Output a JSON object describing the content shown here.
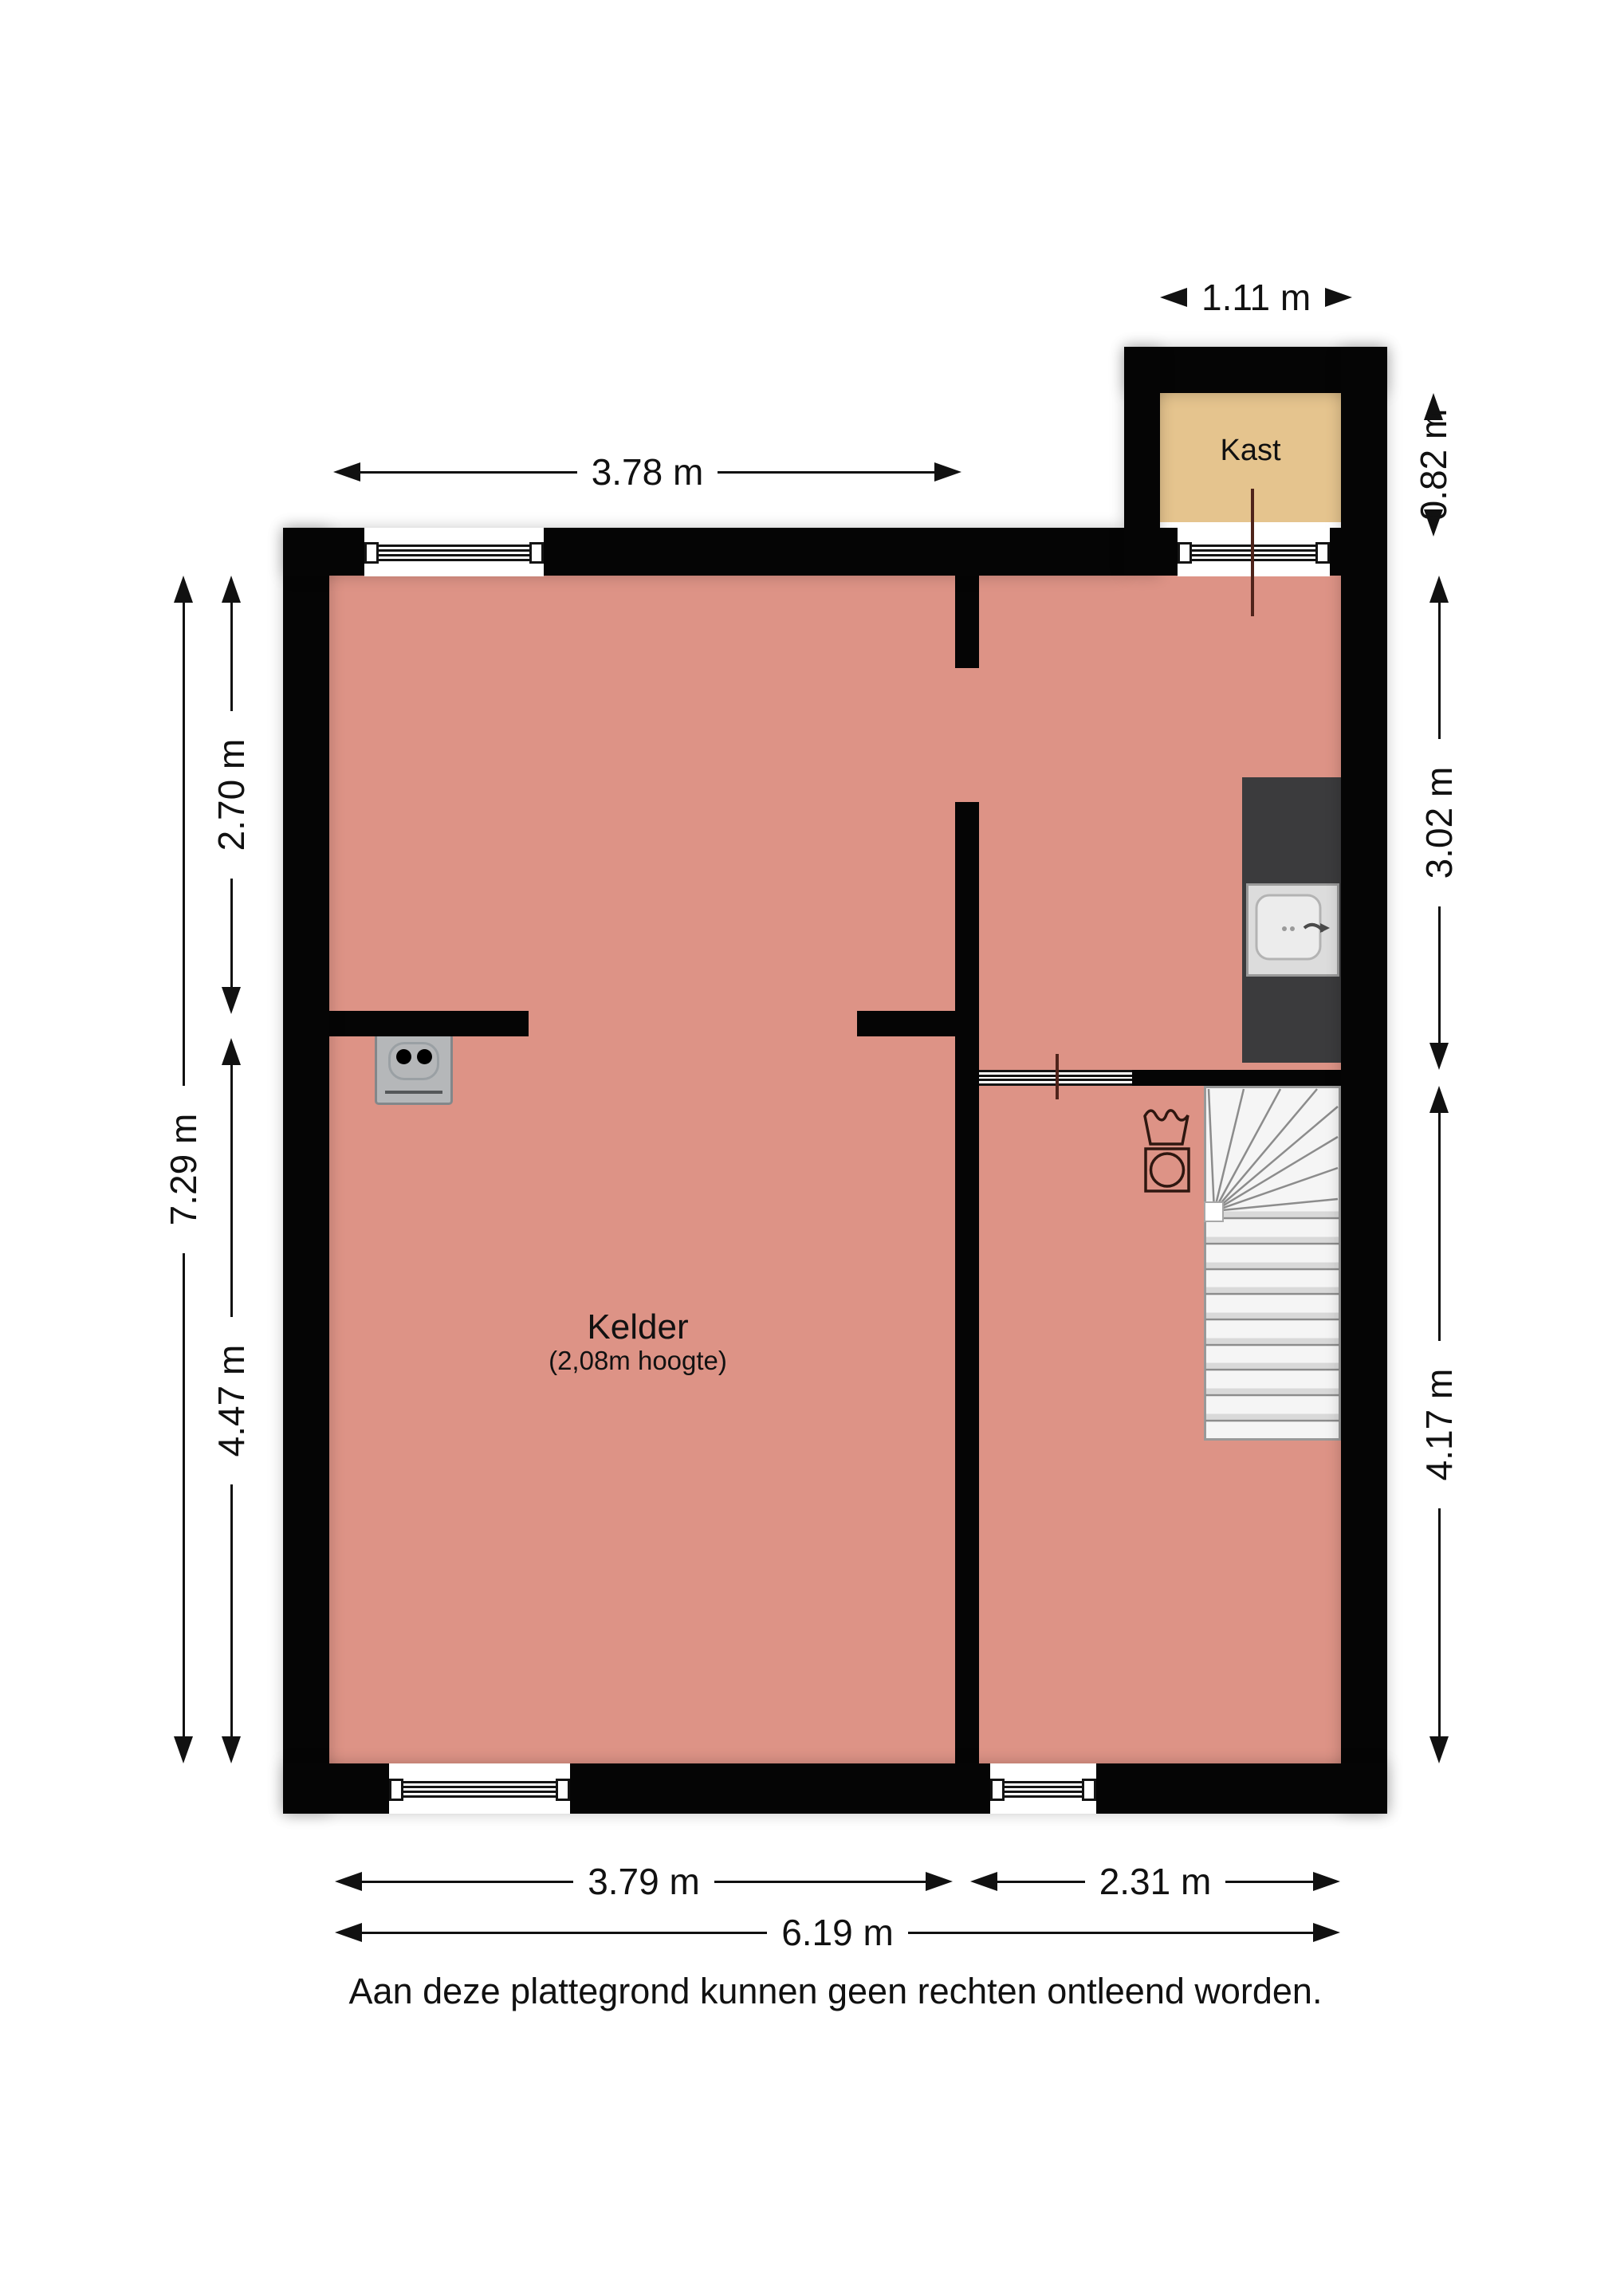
{
  "plan": {
    "type": "floor-plan",
    "floor_label": "Kelder",
    "disclaimer": "Aan deze plattegrond kunnen geen rechten ontleend worden."
  },
  "rooms": {
    "kelder": {
      "name": "Kelder",
      "height_note": "(2,08m hoogte)"
    },
    "kast": {
      "name": "Kast"
    }
  },
  "dimensions": {
    "kast_width": "1.11 m",
    "top_left_width": "3.78 m",
    "kast_depth": "0.82 m",
    "right_upper": "3.02 m",
    "right_lower": "4.17 m",
    "left_upper": "2.70 m",
    "left_lower": "4.47 m",
    "left_total": "7.29 m",
    "bottom_left": "3.79 m",
    "bottom_right": "2.31 m",
    "bottom_total": "6.19 m"
  },
  "icons": {
    "washing_machine": "washing-machine-icon",
    "sink": "kitchen-sink-icon",
    "stairs": "staircase",
    "outlet": "power-outlet"
  },
  "colors": {
    "ink": "#111111",
    "wall": "#050505",
    "floor_pink": "#DD9386",
    "floor_tan": "#E5C48E",
    "counter": "#3B3B3D",
    "stairs_fill": "#F5F5F5",
    "stairs_line": "#8C8C8C",
    "outlet": "#B5B7B9",
    "door": "#4F241B",
    "washer": "#2E1710"
  }
}
